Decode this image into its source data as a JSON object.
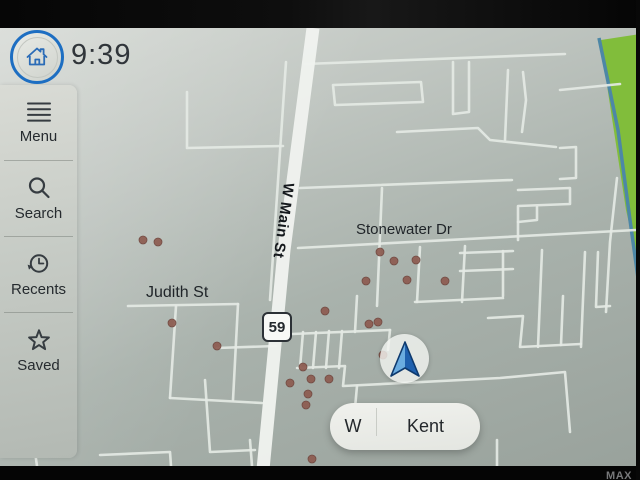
{
  "status_bar": {
    "time": "9:39"
  },
  "home_button": {
    "icon": "home-icon",
    "ring_color": "#1d6ec2"
  },
  "sidebar": {
    "items": [
      {
        "label": "Menu",
        "icon": "hamburger-icon"
      },
      {
        "label": "Search",
        "icon": "search-icon"
      },
      {
        "label": "Recents",
        "icon": "history-icon"
      },
      {
        "label": "Saved",
        "icon": "star-icon"
      }
    ]
  },
  "map": {
    "labels": {
      "main_street": "W Main St",
      "stonewater": "Stonewater Dr",
      "judith": "Judith St"
    },
    "route_shield": "59",
    "position_pill": {
      "direction": "W",
      "city": "Kent"
    },
    "colors": {
      "map_bg_top": "#d3d7d2",
      "map_bg_bottom": "#99a29c",
      "road": "#e4e9e4",
      "main_road": "#eff2ee",
      "park": "#81bd3b",
      "river": "#4d87a6",
      "poi_dot": "#8d5b50",
      "arrow_blue": "#2166b4",
      "accent_blue": "#1d6ec2"
    },
    "main_road": [
      [
        313,
        28
      ],
      [
        284,
        250
      ],
      [
        262,
        480
      ]
    ],
    "streets": [
      [
        [
          187,
          92
        ],
        [
          187,
          148
        ],
        [
          283,
          146
        ]
      ],
      [
        [
          286,
          62
        ],
        [
          270,
          300
        ]
      ],
      [
        [
          128,
          306
        ],
        [
          238,
          304
        ]
      ],
      [
        [
          176,
          306
        ],
        [
          170,
          398
        ]
      ],
      [
        [
          238,
          304
        ],
        [
          233,
          400
        ]
      ],
      [
        [
          170,
          398
        ],
        [
          262,
          403
        ]
      ],
      [
        [
          217,
          348
        ],
        [
          276,
          346
        ]
      ],
      [
        [
          305,
          64
        ],
        [
          565,
          54
        ]
      ],
      [
        [
          333,
          85
        ],
        [
          421,
          82
        ],
        [
          423,
          102
        ],
        [
          335,
          105
        ],
        [
          333,
          85
        ]
      ],
      [
        [
          453,
          62
        ],
        [
          453,
          114
        ],
        [
          469,
          112
        ],
        [
          469,
          62
        ]
      ],
      [
        [
          397,
          132
        ],
        [
          478,
          128
        ],
        [
          490,
          140
        ],
        [
          556,
          147
        ]
      ],
      [
        [
          508,
          70
        ],
        [
          505,
          140
        ]
      ],
      [
        [
          523,
          72
        ],
        [
          526,
          100
        ],
        [
          522,
          132
        ]
      ],
      [
        [
          300,
          188
        ],
        [
          512,
          180
        ]
      ],
      [
        [
          382,
          188
        ],
        [
          377,
          306
        ]
      ],
      [
        [
          298,
          248
        ],
        [
          636,
          230
        ]
      ],
      [
        [
          518,
          190
        ],
        [
          570,
          188
        ],
        [
          570,
          204
        ],
        [
          518,
          206
        ],
        [
          518,
          240
        ]
      ],
      [
        [
          518,
          222
        ],
        [
          537,
          220
        ],
        [
          537,
          207
        ]
      ],
      [
        [
          460,
          253
        ],
        [
          513,
          251
        ]
      ],
      [
        [
          460,
          271
        ],
        [
          513,
          269
        ]
      ],
      [
        [
          503,
          251
        ],
        [
          503,
          296
        ]
      ],
      [
        [
          542,
          250
        ],
        [
          538,
          347
        ]
      ],
      [
        [
          563,
          296
        ],
        [
          561,
          345
        ]
      ],
      [
        [
          585,
          252
        ],
        [
          581,
          347
        ]
      ],
      [
        [
          598,
          252
        ],
        [
          596,
          307
        ],
        [
          610,
          306
        ]
      ],
      [
        [
          488,
          318
        ],
        [
          523,
          316
        ],
        [
          520,
          347
        ],
        [
          581,
          344
        ]
      ],
      [
        [
          617,
          178
        ],
        [
          610,
          242
        ],
        [
          606,
          312
        ]
      ],
      [
        [
          420,
          247
        ],
        [
          417,
          302
        ]
      ],
      [
        [
          465,
          246
        ],
        [
          462,
          302
        ]
      ],
      [
        [
          415,
          302
        ],
        [
          503,
          298
        ]
      ],
      [
        [
          357,
          296
        ],
        [
          355,
          332
        ]
      ],
      [
        [
          292,
          334
        ],
        [
          390,
          330
        ]
      ],
      [
        [
          303,
          332
        ],
        [
          300,
          368
        ]
      ],
      [
        [
          316,
          332
        ],
        [
          313,
          368
        ]
      ],
      [
        [
          329,
          331
        ],
        [
          326,
          368
        ]
      ],
      [
        [
          342,
          331
        ],
        [
          339,
          368
        ]
      ],
      [
        [
          297,
          368
        ],
        [
          345,
          366
        ],
        [
          343,
          386
        ],
        [
          500,
          378
        ],
        [
          565,
          372
        ],
        [
          570,
          432
        ]
      ],
      [
        [
          357,
          386
        ],
        [
          353,
          430
        ]
      ],
      [
        [
          390,
          330
        ],
        [
          388,
          350
        ]
      ],
      [
        [
          205,
          380
        ],
        [
          210,
          452
        ],
        [
          255,
          450
        ]
      ],
      [
        [
          250,
          440
        ],
        [
          252,
          466
        ]
      ],
      [
        [
          100,
          455
        ],
        [
          170,
          452
        ],
        [
          171,
          466
        ]
      ],
      [
        [
          35,
          452
        ],
        [
          37,
          466
        ]
      ],
      [
        [
          497,
          440
        ],
        [
          497,
          466
        ]
      ],
      [
        [
          560,
          90
        ],
        [
          620,
          84
        ]
      ],
      [
        [
          560,
          148
        ],
        [
          576,
          147
        ],
        [
          576,
          178
        ],
        [
          560,
          179
        ]
      ]
    ],
    "river": [
      [
        599,
        38
      ],
      [
        618,
        130
      ],
      [
        630,
        220
      ],
      [
        638,
        278
      ]
    ],
    "park": [
      [
        601,
        40
      ],
      [
        640,
        34
      ],
      [
        640,
        272
      ],
      [
        626,
        210
      ],
      [
        608,
        92
      ]
    ],
    "poi_dots": [
      [
        143,
        240
      ],
      [
        158,
        242
      ],
      [
        172,
        323
      ],
      [
        217,
        346
      ],
      [
        380,
        252
      ],
      [
        394,
        261
      ],
      [
        416,
        260
      ],
      [
        366,
        281
      ],
      [
        407,
        280
      ],
      [
        445,
        281
      ],
      [
        325,
        311
      ],
      [
        369,
        324
      ],
      [
        378,
        322
      ],
      [
        383,
        355
      ],
      [
        303,
        367
      ],
      [
        290,
        383
      ],
      [
        311,
        379
      ],
      [
        329,
        379
      ],
      [
        308,
        394
      ],
      [
        306,
        405
      ],
      [
        312,
        459
      ]
    ]
  },
  "bezel": {
    "bottom_right_text": "MAX"
  }
}
